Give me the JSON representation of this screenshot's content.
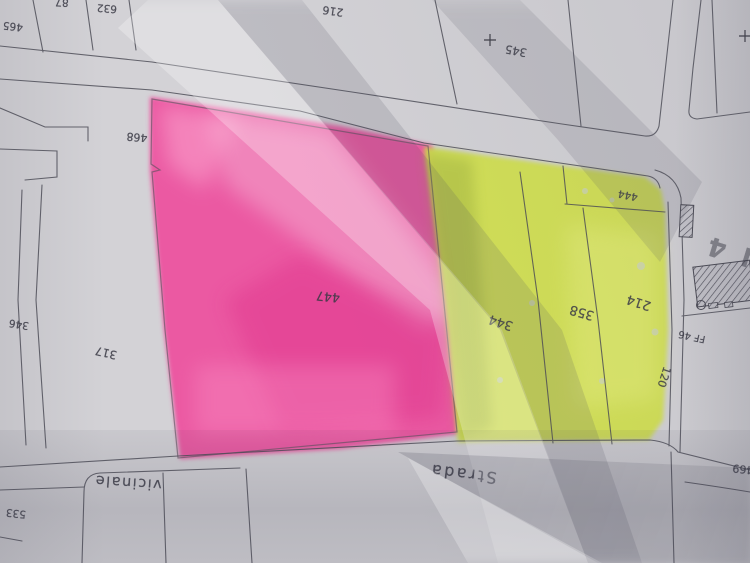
{
  "labels": {
    "p465": "465",
    "p87": "87",
    "p632": "632",
    "p216": "216",
    "p345": "345",
    "p468": "468",
    "p317": "317",
    "p346": "346",
    "p533": "533",
    "p447": "447",
    "p344": "344",
    "p358": "358",
    "p214": "214",
    "p444": "444",
    "p120": "120",
    "p469": "469",
    "strada": "Strada",
    "vicinale": "vicinale",
    "ff46": "FF 46",
    "n4": "N 4"
  },
  "colors": {
    "pink": "#ee4f9d",
    "yellow": "#d2e04f",
    "paper": "#d2d1d6",
    "ink": "#3a3a45"
  }
}
